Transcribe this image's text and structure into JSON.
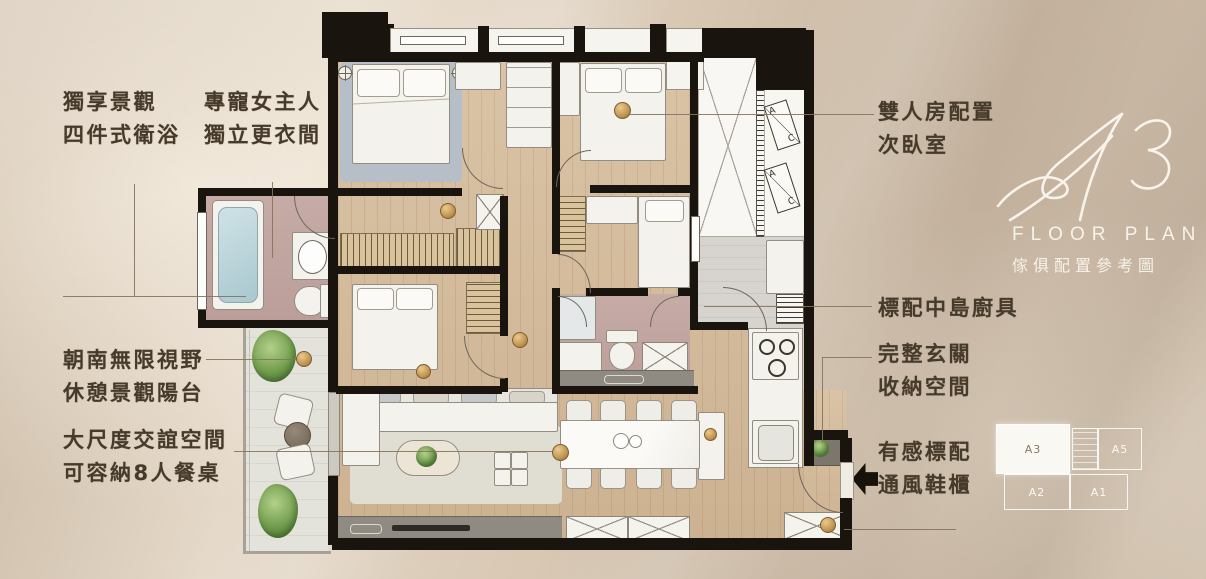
{
  "logo": {
    "unit_script": "A3",
    "subtitle": "FLOOR PLAN",
    "caption": "傢俱配置參考圖"
  },
  "annotations": {
    "left": [
      {
        "id": "master-bath",
        "lines": [
          "獨享景觀",
          "四件式衛浴"
        ]
      },
      {
        "id": "walkin-closet",
        "lines": [
          "專寵女主人",
          "獨立更衣間"
        ]
      },
      {
        "id": "balcony",
        "lines": [
          "朝南無限視野",
          "休憩景觀陽台"
        ]
      },
      {
        "id": "living-dining",
        "lines": [
          "大尺度交誼空間",
          "可容納8人餐桌"
        ]
      }
    ],
    "right": [
      {
        "id": "second-bedroom",
        "lines": [
          "雙人房配置",
          "次臥室"
        ]
      },
      {
        "id": "island-kitchen",
        "lines": [
          "標配中島廚具"
        ]
      },
      {
        "id": "foyer-storage",
        "lines": [
          "完整玄關",
          "收納空間"
        ]
      },
      {
        "id": "shoe-cabinet",
        "lines": [
          "有感標配",
          "通風鞋櫃"
        ]
      }
    ]
  },
  "plan": {
    "ac": {
      "a": "A",
      "c": "C"
    }
  },
  "keyplan": {
    "units": [
      {
        "label": "A3",
        "highlighted": true
      },
      {
        "label": "A5",
        "highlighted": false
      },
      {
        "label": "A2",
        "highlighted": false
      },
      {
        "label": "A1",
        "highlighted": false
      }
    ]
  },
  "colors": {
    "background": "#d5c5b1",
    "wall": "#1a140f",
    "wood_floor": "#d3ba9b",
    "bath_floor": "#c2a6a1",
    "balcony_floor": "#e3e3db",
    "kitchen_floor": "#d7d4cf",
    "text": "#463a2b",
    "logo_text": "#f8f3ea",
    "leader_line": "#85745a"
  }
}
